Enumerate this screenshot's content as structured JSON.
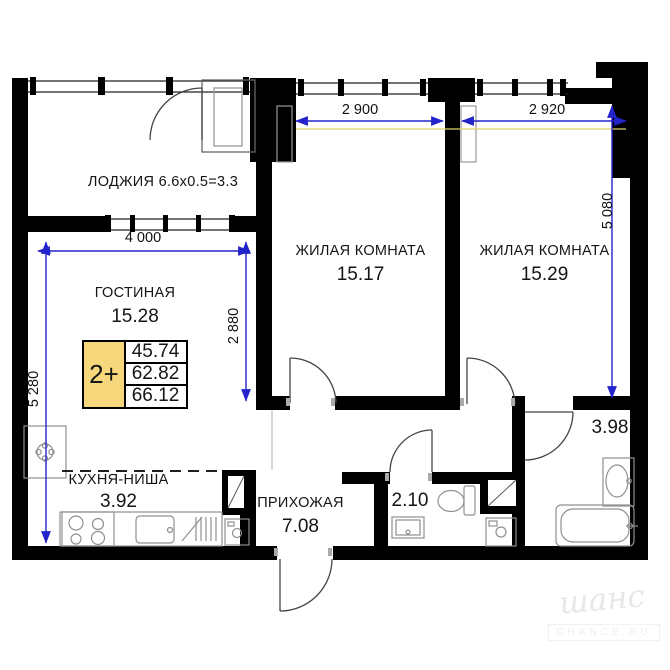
{
  "rooms": {
    "loggia": {
      "label": "ЛОДЖИЯ 6.6x0.5=3.3"
    },
    "living": {
      "label": "ГОСТИНАЯ",
      "area": "15.28"
    },
    "bedroom1": {
      "label": "ЖИЛАЯ КОМНАТА",
      "area": "15.17"
    },
    "bedroom2": {
      "label": "ЖИЛАЯ КОМНАТА",
      "area": "15.29"
    },
    "kitchen": {
      "label": "КУХНЯ-НИША",
      "area": "3.92"
    },
    "hallway": {
      "label": "ПРИХОЖАЯ",
      "area": "7.08"
    },
    "wc": {
      "area": "2.10"
    },
    "bathroom": {
      "area": "3.98"
    }
  },
  "dimensions": {
    "bedroom1_width": "2 900",
    "bedroom2_width": "2 920",
    "bedroom2_height": "5 080",
    "living_width": "4 000",
    "living_height": "5 280",
    "living_wall_height": "2 880"
  },
  "stamp": {
    "layout_type": "2+",
    "areas": [
      "45.74",
      "62.82",
      "66.12"
    ]
  },
  "watermark": {
    "name": "шанс",
    "site": "CHANCE.RU"
  },
  "colors": {
    "wall": "#000000",
    "dimension": "#2323cc",
    "guide": "#ded26a",
    "stamp_fill": "#f6d77b"
  }
}
